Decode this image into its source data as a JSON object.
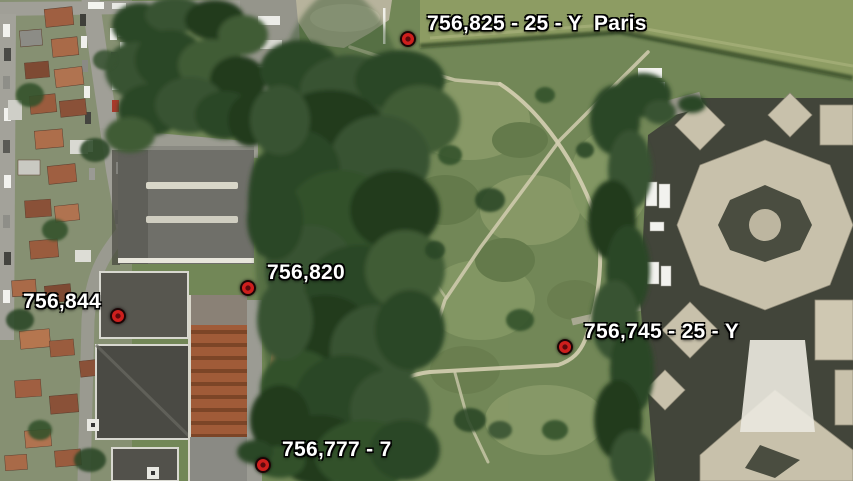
{
  "map": {
    "placemarks": [
      {
        "label": "756,825 - 25 - Y  Paris"
      },
      {
        "label": "756,820"
      },
      {
        "label": "756,844"
      },
      {
        "label": "756,745 - 25 - Y"
      },
      {
        "label": "756,777 - 7"
      }
    ],
    "marker_color": "#ce1f1d",
    "label_color": "#ffffff"
  }
}
